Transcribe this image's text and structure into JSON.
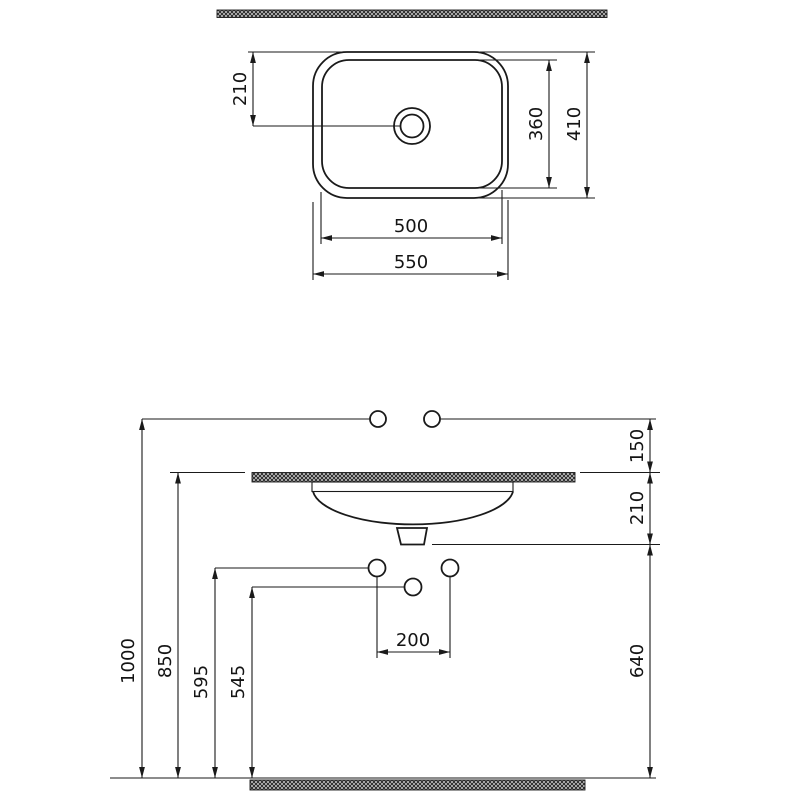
{
  "drawing": {
    "subject": "washbasin installation dimension drawing",
    "views": {
      "top_view": "plan of basin with drain",
      "front_view": "wall elevation with mounting heights"
    },
    "colors": {
      "line": "#1a1a1a",
      "background": "#ffffff",
      "hatch_dark": "#2b2b2b",
      "hatch_light": "#d8d8d8"
    }
  },
  "dims": {
    "top_drain_offset": "210",
    "top_inner_length": "360",
    "top_outer_length": "410",
    "top_inner_width": "500",
    "top_outer_width": "550",
    "front_faucet_height": "150",
    "front_counter_drain": "210",
    "front_total_height": "1000",
    "front_counter_height": "850",
    "front_conn_upper": "595",
    "front_conn_lower": "545",
    "front_conn_spacing": "200",
    "front_drain_floor": "640"
  }
}
